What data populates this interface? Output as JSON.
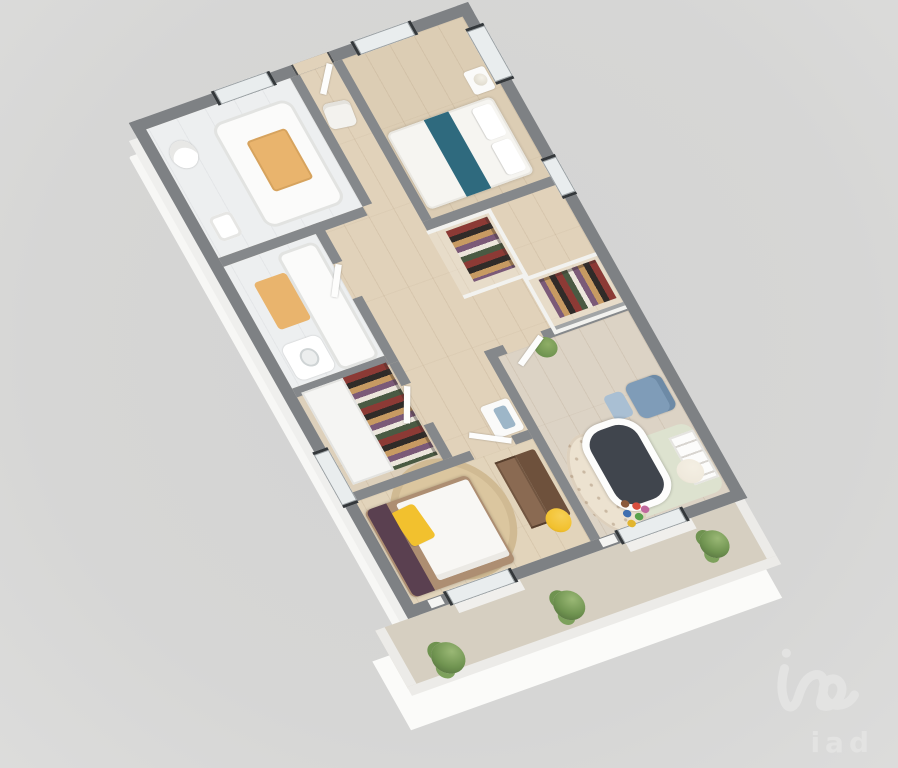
{
  "watermark": {
    "text": "iad",
    "logo_icon": "iad-script-logo"
  },
  "theme": {
    "bg": "#d6d6d5",
    "bgMid": "#d3d3d2",
    "bgEdge": "#dcdcdb",
    "wall": "#7e8184",
    "wallIn": "#85888b",
    "wallFace": "#f7f7f5",
    "parapet": "#eceb e8",
    "parapetTop": "#ecebe8",
    "woodFloor": "#e1d2ba",
    "bathFloor": "#edeff0",
    "balconyFloor": "#d6cfc1",
    "glass": "#e9edee",
    "teal": "#2f6a7e",
    "tan": "#e9b46d",
    "yellow": "#f2c12e",
    "plum": "#5a4050",
    "brown": "#8a6a52",
    "brownDark": "#6e513c",
    "blue": "#7f9cb8",
    "blueLight": "#a9bfd3",
    "cream": "#efe9dc",
    "rugTan": "#dbc69f",
    "green": "#7da15c",
    "cribDark": "#40454d",
    "white": "#fafaf9",
    "bedframe": "#ad8e72",
    "wmColor": "#e3e3e2"
  },
  "floorplan": {
    "view": "3d-axonometric-floor-plan",
    "rooms": [
      {
        "id": "bedroom-1",
        "name": "Bedroom 1"
      },
      {
        "id": "entry",
        "name": "Entry"
      },
      {
        "id": "bathroom-1",
        "name": "Bathroom 1"
      },
      {
        "id": "bathroom-2",
        "name": "Bathroom 2"
      },
      {
        "id": "dressing",
        "name": "Dressing"
      },
      {
        "id": "hallway",
        "name": "Hallway"
      },
      {
        "id": "nursery",
        "name": "Nursery"
      },
      {
        "id": "master-bedroom",
        "name": "Master Bedroom"
      },
      {
        "id": "balcony",
        "name": "Balcony"
      }
    ],
    "furniture": [
      {
        "id": "double-bed-teal-runner",
        "room": "bedroom-1"
      },
      {
        "id": "nightstand-lamp",
        "room": "bedroom-1"
      },
      {
        "id": "armchair-white",
        "room": "entry"
      },
      {
        "id": "bathtub-wood-tray",
        "room": "bathroom-1"
      },
      {
        "id": "toilet",
        "room": "bathroom-1"
      },
      {
        "id": "bathtub",
        "room": "bathroom-2"
      },
      {
        "id": "washbasin",
        "room": "bathroom-2"
      },
      {
        "id": "wardrobe-clothes-rail",
        "room": "hallway"
      },
      {
        "id": "wardrobe-clothes-rail",
        "room": "nursery"
      },
      {
        "id": "wardrobe-clothes-rail",
        "room": "dressing"
      },
      {
        "id": "crib",
        "room": "nursery"
      },
      {
        "id": "armchair-blue",
        "room": "nursery"
      },
      {
        "id": "ladder-shelf",
        "room": "nursery"
      },
      {
        "id": "pouf-cream",
        "room": "nursery"
      },
      {
        "id": "patterned-rug",
        "room": "nursery"
      },
      {
        "id": "toys",
        "room": "nursery"
      },
      {
        "id": "double-bed-yellow-pillow",
        "room": "master-bedroom"
      },
      {
        "id": "round-rug",
        "room": "master-bedroom"
      },
      {
        "id": "dresser-desk",
        "room": "master-bedroom"
      },
      {
        "id": "pouf-yellow",
        "room": "master-bedroom"
      },
      {
        "id": "bushes",
        "room": "balcony"
      }
    ]
  }
}
